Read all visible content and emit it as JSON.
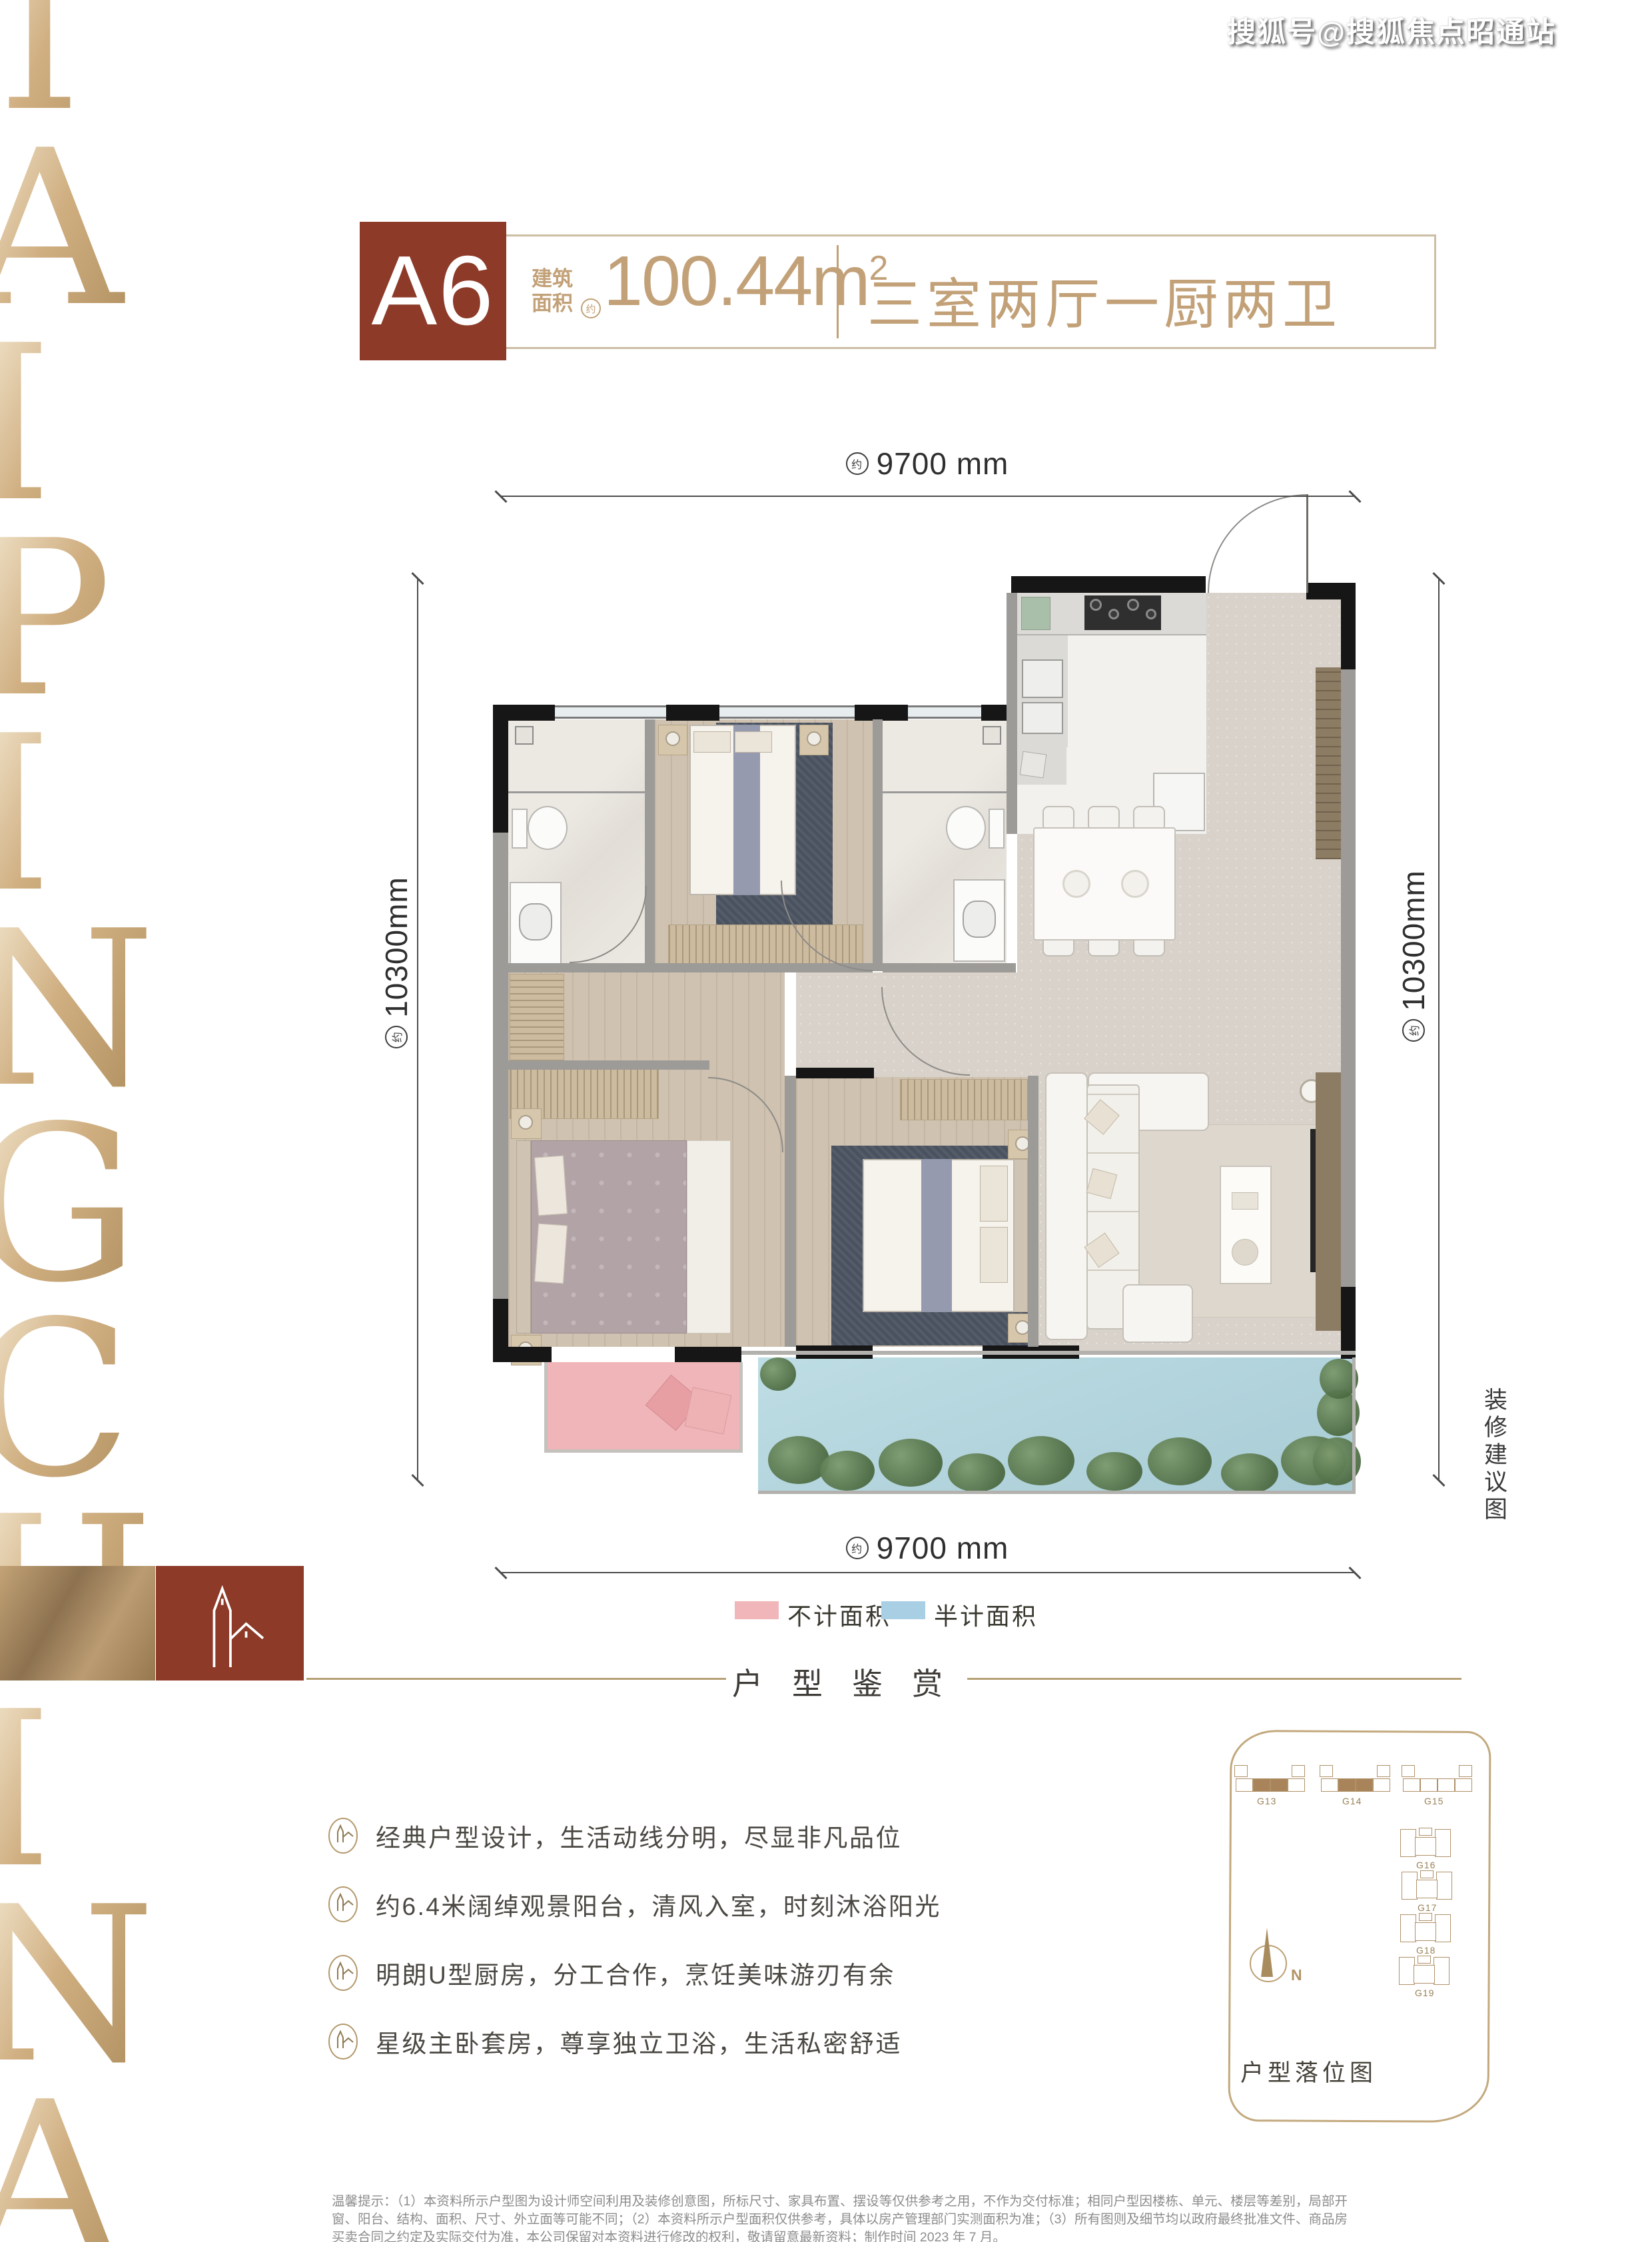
{
  "watermark": "搜狐号@搜狐焦点昭通站",
  "brand": {
    "name": "TAIPING CHINA",
    "letters": [
      "T",
      "A",
      "I",
      "P",
      "I",
      "N",
      "G",
      "C",
      "H",
      "I",
      "N",
      "A"
    ]
  },
  "header": {
    "unit": "A6",
    "area_line1": "建筑",
    "area_line2": "面积",
    "approx": "约",
    "area_value": "100.44m",
    "area_sup": "2",
    "layout": "三室两厅一厨两卫"
  },
  "dims": {
    "approx": "约",
    "top": "9700 mm",
    "bottom": "9700 mm",
    "left": "10300mm",
    "right": "10300mm"
  },
  "side_note": "装修建议图",
  "side_note_chars": [
    "装",
    "修",
    "建",
    "议",
    "图"
  ],
  "legend": {
    "items": [
      {
        "label": "不计面积",
        "color": "#f0b6ba"
      },
      {
        "label": "半计面积",
        "color": "#a9cfe5"
      }
    ]
  },
  "section": {
    "title": "户型鉴赏"
  },
  "features": [
    {
      "text": "经典户型设计，生活动线分明，尽显非凡品位"
    },
    {
      "text": "约6.4米阔绰观景阳台，清风入室，时刻沐浴阳光"
    },
    {
      "text": "明朗U型厨房，分工合作，烹饪美味游刃有余"
    },
    {
      "text": "星级主卧套房，尊享独立卫浴，生活私密舒适"
    }
  ],
  "site_plan": {
    "caption": "户型落位图",
    "compass": "N",
    "buildings_top": [
      "G13",
      "G14",
      "G15"
    ],
    "buildings_right": [
      "G16",
      "G17",
      "G18",
      "G19"
    ]
  },
  "disclaimer": "温馨提示：（1）本资料所示户型图为设计师空间利用及装修创意图，所标尺寸、家具布置、摆设等仅供参考之用，不作为交付标准；相同户型因楼栋、单元、楼层等差别，局部开窗、阳台、结构、面积、尺寸、外立面等可能不同；（2）本资料所示户型面积仅供参考，具体以房产管理部门实测面积为准；（3）所有图则及细节均以政府最终批准文件、商品房买卖合同之约定及实际交付为准，本公司保留对本资料进行修改的权利，敬请留意最新资料；制作时间 2023 年 7 月。",
  "colors": {
    "maroon": "#8d3a28",
    "gold_text": "#c2a178",
    "gold_border": "#ccbda4",
    "wall_black": "#161616",
    "wall_gray": "#9d9b97",
    "balcony_water": "#aed3dc",
    "terrace_pink": "#efb5b9",
    "legend_pink": "#f0b6ba",
    "legend_blue": "#a9cfe5"
  }
}
